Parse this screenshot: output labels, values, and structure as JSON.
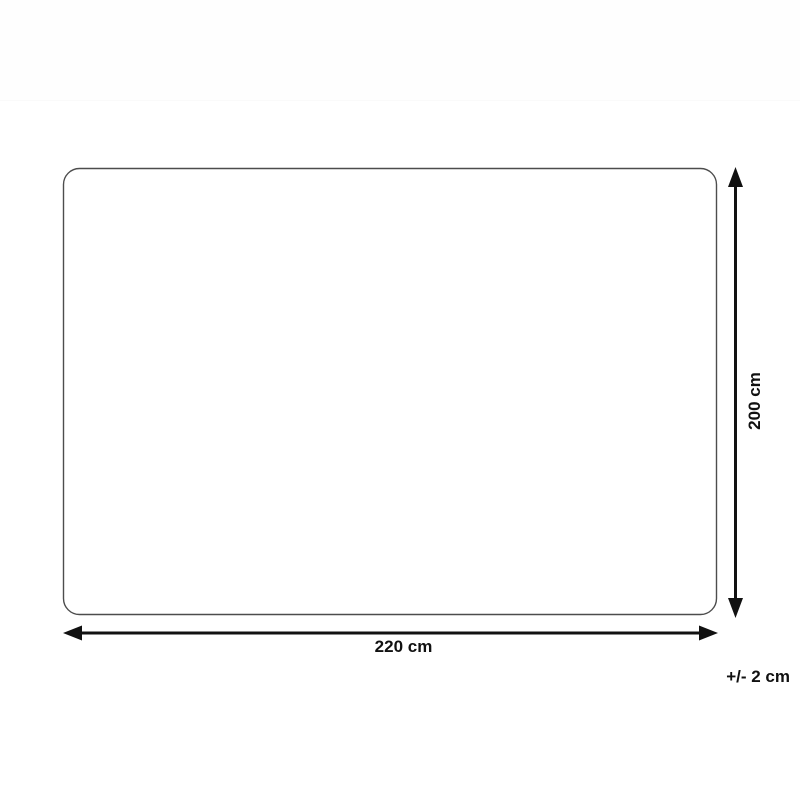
{
  "diagram": {
    "width_label": "220 cm",
    "height_label": "200 cm",
    "tolerance_label": "+/- 2 cm",
    "colors": {
      "arrow": "#111111",
      "outline": "#4d4d4d",
      "text": "#111111",
      "background": "#ffffff"
    }
  }
}
